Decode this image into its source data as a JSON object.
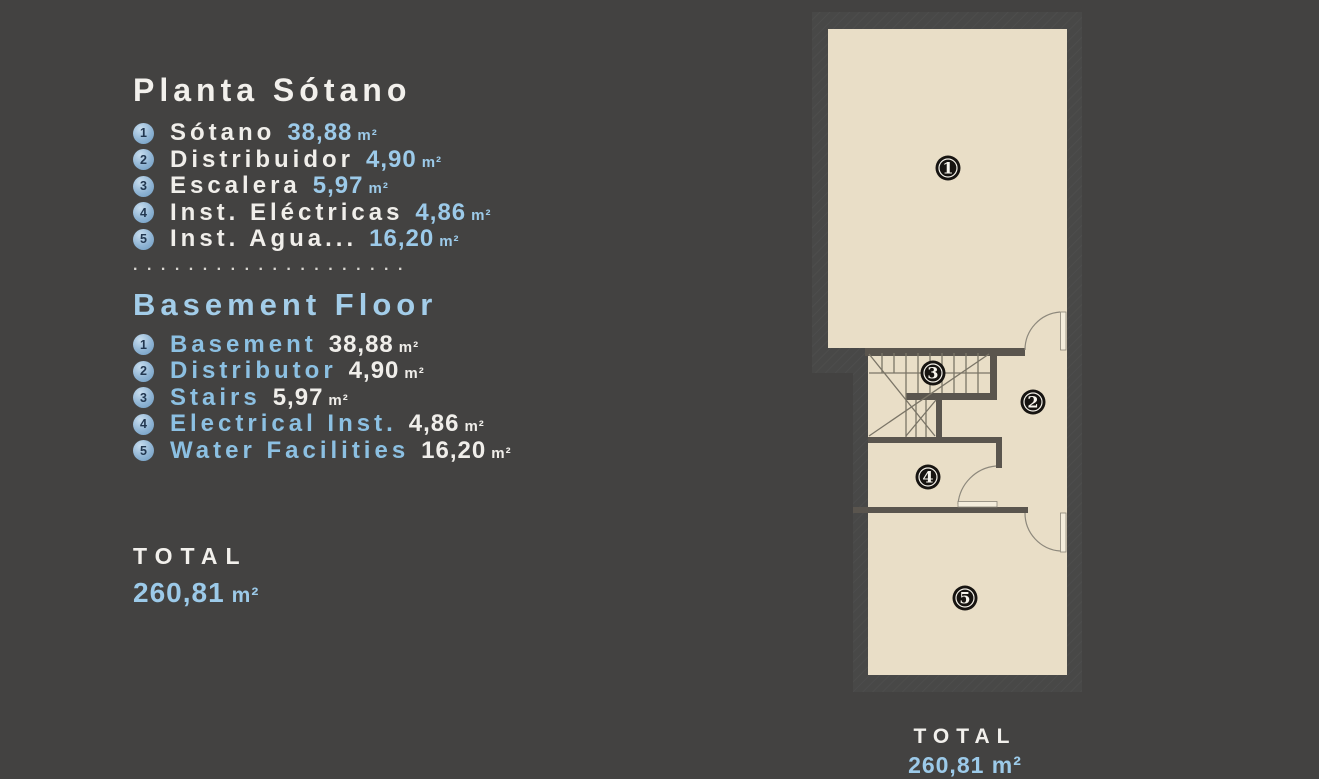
{
  "canvas": {
    "background": "#434241"
  },
  "legend_es": {
    "title": "Planta Sótano",
    "items": [
      {
        "num": "1",
        "name": "Sótano",
        "value": "38,88",
        "unit": "m²"
      },
      {
        "num": "2",
        "name": "Distribuidor",
        "value": "4,90",
        "unit": "m²"
      },
      {
        "num": "3",
        "name": "Escalera",
        "value": "5,97",
        "unit": "m²"
      },
      {
        "num": "4",
        "name": "Inst. Eléctricas",
        "value": "4,86",
        "unit": "m²"
      },
      {
        "num": "5",
        "name": "Inst. Agua...",
        "value": "16,20",
        "unit": "m²"
      }
    ]
  },
  "separator": "....................",
  "legend_en": {
    "title": "Basement Floor",
    "items": [
      {
        "num": "1",
        "name": "Basement",
        "value": "38,88",
        "unit": "m²"
      },
      {
        "num": "2",
        "name": "Distributor",
        "value": "4,90",
        "unit": "m²"
      },
      {
        "num": "3",
        "name": "Stairs",
        "value": "5,97",
        "unit": "m²"
      },
      {
        "num": "4",
        "name": "Electrical Inst.",
        "value": "4,86",
        "unit": "m²"
      },
      {
        "num": "5",
        "name": "Water Facilities",
        "value": "16,20",
        "unit": "m²"
      }
    ]
  },
  "total": {
    "label": "TOTAL",
    "value": "260,81",
    "unit": "m²"
  },
  "floorplan": {
    "bottom_label": "TOTAL",
    "bottom_value": "260,81 m²",
    "markers": [
      {
        "num": "1"
      },
      {
        "num": "2"
      },
      {
        "num": "3"
      },
      {
        "num": "4"
      },
      {
        "num": "5"
      }
    ],
    "colors": {
      "floor": "#e9dec7",
      "exterior_wall": "#484847",
      "interior_wall": "#5a554e",
      "marker": "#171411"
    }
  }
}
